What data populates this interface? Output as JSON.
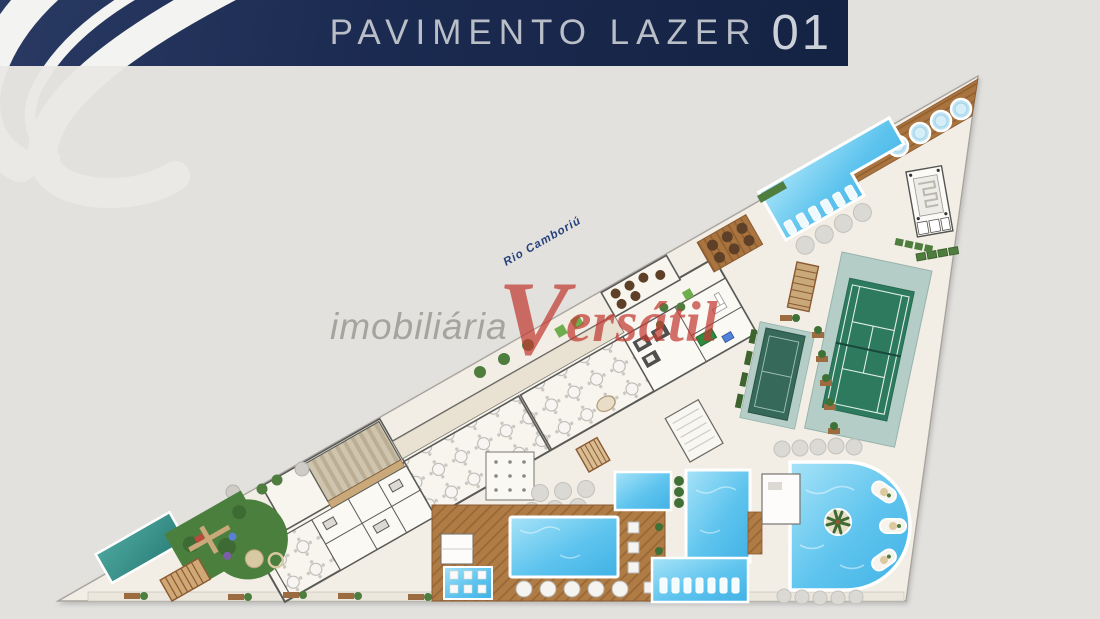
{
  "header": {
    "title": "PAVIMENTO LAZER",
    "number": "01"
  },
  "watermark": {
    "prefix": "imobiliária",
    "brand_initial": "V",
    "brand_rest": "ersátil"
  },
  "plan": {
    "river_label": "Rio Camboriú",
    "features": [
      "river-promenade-deck",
      "spa-hot-tubs",
      "upper-pool",
      "water-structure",
      "tennis-court",
      "sports-court",
      "pergola",
      "barbecue-area",
      "party-halls",
      "auditorium-steps",
      "spa-rooms",
      "game-room",
      "kids-playground",
      "lap-pool",
      "main-pool-palm-island",
      "pool-bar",
      "wood-deck-pools",
      "sun-loungers",
      "swim-up-bar"
    ],
    "colors": {
      "header_navy": "#1b2a50",
      "page_gray": "#e2e1de",
      "plan_cream": "#f2eee5",
      "pool_blue": "#5ec4ee",
      "lap_pool_teal": "#3a958c",
      "court_green": "#2d7a5f",
      "wood_brown": "#a9743f",
      "grass_green": "#4b7f3d",
      "brand_red": "#c23b33"
    }
  }
}
